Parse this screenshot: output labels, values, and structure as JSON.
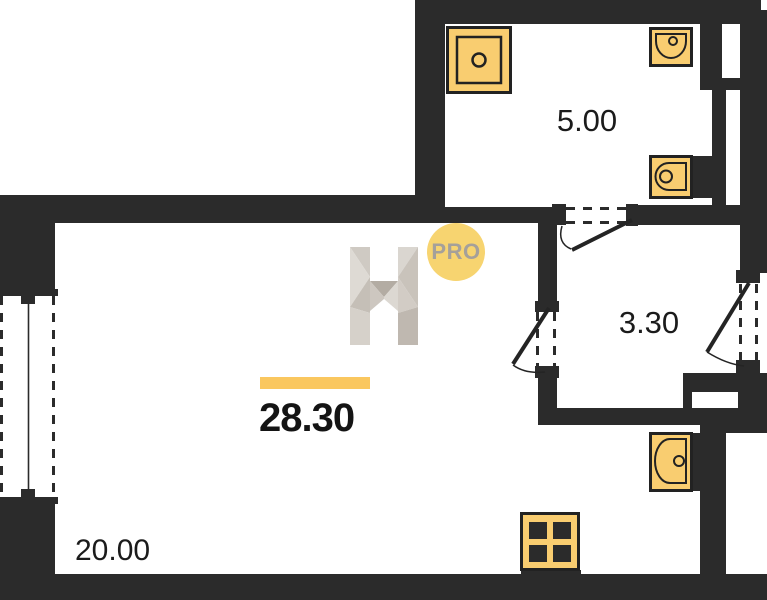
{
  "floor_plan": {
    "type": "apartment-floor-plan",
    "watermark": {
      "badge_text": "PRO"
    },
    "areas": {
      "bathroom": "5.00",
      "hallway": "3.30",
      "total": "28.30",
      "living_kitchen": "20.00"
    },
    "colors": {
      "wall": "#2b2b2b",
      "bg": "#ffffff",
      "fixture_fill": "#F9CD70",
      "fixture_stroke": "#222222",
      "bar": "#FAC75F",
      "badge": "#F7D470",
      "badgetext": "#A5A09A",
      "label": "#1b1b1b"
    },
    "fixtures": [
      {
        "name": "shower-icon",
        "room": "bathroom"
      },
      {
        "name": "bathroom-sink-icon",
        "room": "bathroom"
      },
      {
        "name": "toilet-icon",
        "room": "bathroom"
      },
      {
        "name": "kitchen-sink-icon",
        "room": "living_kitchen"
      },
      {
        "name": "stove-icon",
        "room": "living_kitchen"
      }
    ],
    "openings": [
      {
        "name": "window",
        "wall": "left"
      },
      {
        "name": "bathroom-door"
      },
      {
        "name": "hallway-door"
      },
      {
        "name": "entrance-door"
      }
    ]
  }
}
